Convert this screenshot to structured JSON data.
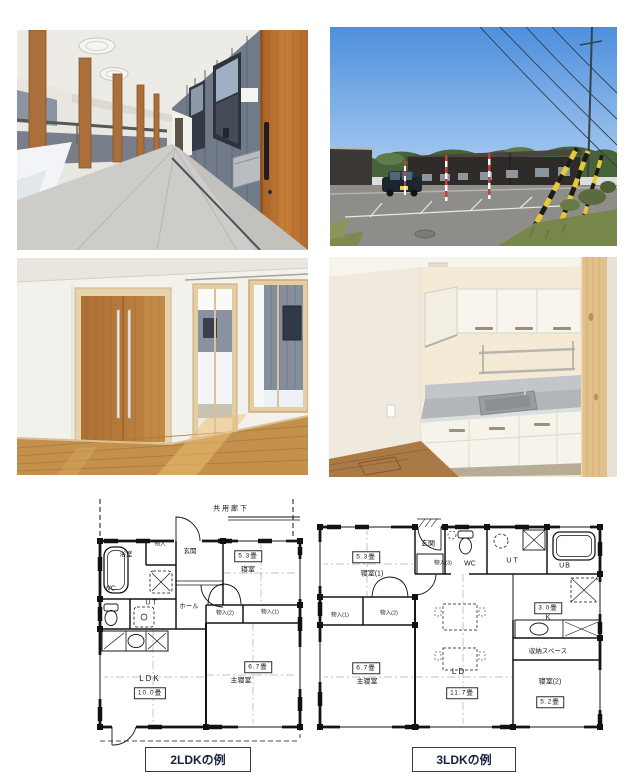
{
  "photos": [
    {
      "id": "covered-walkway-photo"
    },
    {
      "id": "building-exterior-photo"
    },
    {
      "id": "interior-room-photo"
    },
    {
      "id": "kitchen-photo"
    }
  ],
  "plan2": {
    "caption": "2LDKの例",
    "corridor": "共用廊下",
    "rooms": {
      "bath": "浴室",
      "closet": "物入",
      "entrance": "玄関",
      "bedroom": "寝室",
      "bedroom_size": "5.3畳",
      "wc": "WC",
      "ut": "UT",
      "hall": "ホール",
      "closet2": "物入(2)",
      "closet1": "物入(1)",
      "ldk": "LDK",
      "ldk_size": "10.0畳",
      "master": "主寝室",
      "master_size": "6.7畳"
    }
  },
  "plan3": {
    "caption": "3LDKの例",
    "rooms": {
      "bedroom1": "寝室(1)",
      "bedroom1_size": "5.3畳",
      "entrance": "玄関",
      "closet3": "物入(3)",
      "wc": "WC",
      "ut": "UT",
      "ub": "UB",
      "k": "K",
      "k_size": "3.0畳",
      "closet1": "物入(1)",
      "closet2": "物入(2)",
      "master": "主寝室",
      "master_size": "6.7畳",
      "ld": "LD",
      "ld_size": "11.7畳",
      "storage": "収納スペース",
      "bedroom2": "寝室(2)",
      "bedroom2_size": "5.2畳"
    }
  }
}
